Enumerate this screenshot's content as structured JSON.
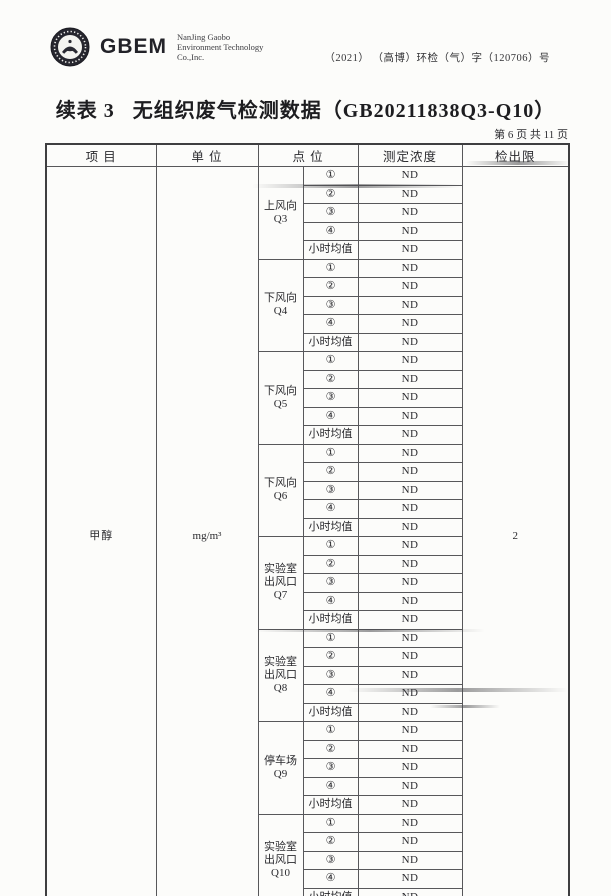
{
  "header": {
    "logo_text": "GBEM",
    "company_lines": [
      "NanJing Gaobo",
      "Environment Technology",
      "Co.,Inc."
    ],
    "doc_number": "（2021） （高博）环检（气）字（120706）号"
  },
  "title": "续表 3   无组织废气检测数据（GB20211838Q3-Q10）",
  "page_indicator": "第 6 页 共 11 页",
  "table": {
    "columns": [
      "项  目",
      "单  位",
      "点  位",
      "测定浓度",
      "检出限"
    ],
    "item": "甲醇",
    "unit": "mg/m³",
    "detection_limit": "2",
    "sub_rows": [
      "①",
      "②",
      "③",
      "④",
      "小时均值"
    ],
    "groups": [
      {
        "label_lines": [
          "上风向",
          "Q3"
        ],
        "values": [
          "ND",
          "ND",
          "ND",
          "ND",
          "ND"
        ]
      },
      {
        "label_lines": [
          "下风向",
          "Q4"
        ],
        "values": [
          "ND",
          "ND",
          "ND",
          "ND",
          "ND"
        ]
      },
      {
        "label_lines": [
          "下风向",
          "Q5"
        ],
        "values": [
          "ND",
          "ND",
          "ND",
          "ND",
          "ND"
        ]
      },
      {
        "label_lines": [
          "下风向",
          "Q6"
        ],
        "values": [
          "ND",
          "ND",
          "ND",
          "ND",
          "ND"
        ]
      },
      {
        "label_lines": [
          "实验室",
          "出风口",
          "Q7"
        ],
        "values": [
          "ND",
          "ND",
          "ND",
          "ND",
          "ND"
        ]
      },
      {
        "label_lines": [
          "实验室",
          "出风口",
          "Q8"
        ],
        "values": [
          "ND",
          "ND",
          "ND",
          "ND",
          "ND"
        ]
      },
      {
        "label_lines": [
          "停车场",
          "Q9"
        ],
        "values": [
          "ND",
          "ND",
          "ND",
          "ND",
          "ND"
        ]
      },
      {
        "label_lines": [
          "实验室",
          "出风口",
          "Q10"
        ],
        "values": [
          "ND",
          "ND",
          "ND",
          "ND",
          "ND"
        ]
      }
    ]
  }
}
